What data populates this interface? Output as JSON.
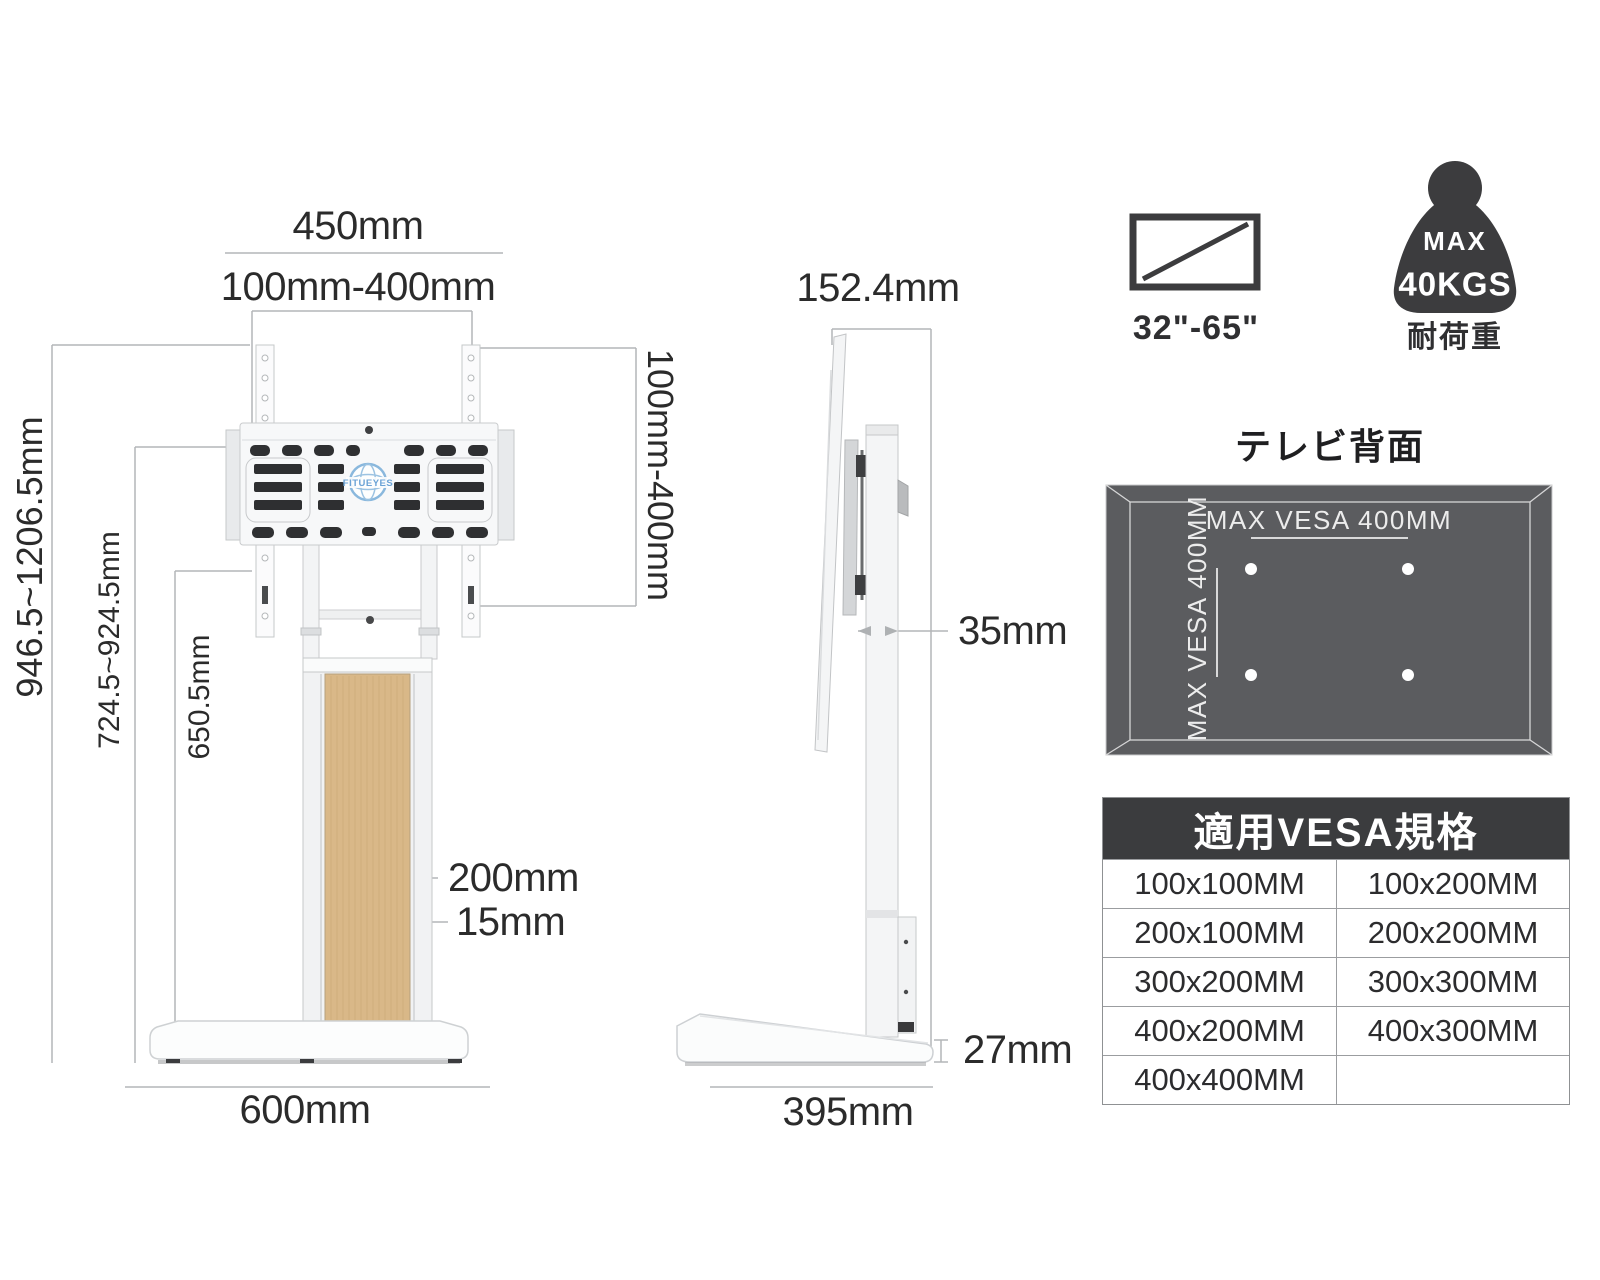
{
  "front_view": {
    "logo_text": "FITUEYES",
    "dim_width_top": "450mm",
    "dim_vesa_width": "100mm-400mm",
    "dim_height_range": "946.5~1206.5mm",
    "dim_mid_height_range": "724.5~924.5mm",
    "dim_column_height": "650.5mm",
    "dim_column_width": "200mm",
    "dim_frame_edge": "15mm",
    "dim_base_width": "600mm",
    "dim_vesa_height": "100mm-400mm"
  },
  "side_view": {
    "dim_top_depth": "152.4mm",
    "dim_pole_depth": "35mm",
    "dim_base_thickness": "27mm",
    "dim_base_depth": "395mm"
  },
  "badges": {
    "screen_size_range": "32\"-65\"",
    "weight_max_label": "MAX",
    "weight_value": "40KGS",
    "weight_caption": "耐荷重"
  },
  "tv_back_diagram": {
    "title": "テレビ背面",
    "horizontal_vesa": "MAX VESA 400MM",
    "vertical_vesa": "MAX VESA 400MM"
  },
  "vesa_table": {
    "title": "適用VESA規格",
    "rows": [
      [
        "100x100MM",
        "100x200MM"
      ],
      [
        "200x100MM",
        "200x200MM"
      ],
      [
        "300x200MM",
        "300x300MM"
      ],
      [
        "400x200MM",
        "400x300MM"
      ],
      [
        "400x400MM",
        ""
      ]
    ]
  },
  "colors": {
    "icon_dark": "#3c3c3e",
    "panel_gray": "#5b5c5f",
    "wood": "#d9b888",
    "logo_blue": "#7fb2da",
    "dim_line": "#b3b6b8"
  }
}
